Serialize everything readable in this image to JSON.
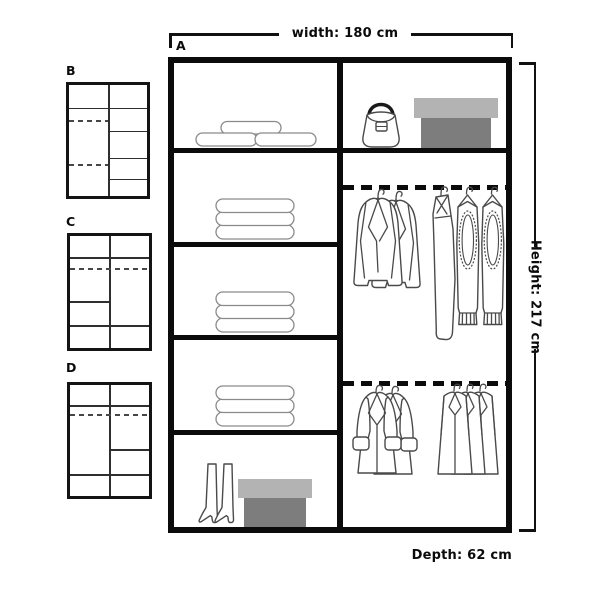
{
  "labels": {
    "width": "width: 180 cm",
    "height": "Height: 217 cm",
    "depth": "Depth: 62 cm"
  },
  "variants": {
    "main": "A",
    "b": "B",
    "c": "C",
    "d": "D"
  },
  "colors": {
    "background": "#ffffff",
    "line": "#0b0b0b",
    "sketch": "#4a4a4a",
    "soft_sketch": "#8a8a8a",
    "box_lid": "#b3b3b3",
    "box_body": "#7d7d7d"
  },
  "illustrations": {
    "top_left_shelf": "duvet-rolls",
    "shelf_2": "folded-clothes",
    "shelf_3": "folded-clothes",
    "shelf_4": "folded-clothes",
    "bottom_left_shelf": "boots-and-shoe-box",
    "top_right_shelf": "handbag-and-storage-box",
    "upper_rail": "jackets-and-knitwear-on-hangers",
    "lower_rail": "coats-and-shirts-on-hangers"
  }
}
